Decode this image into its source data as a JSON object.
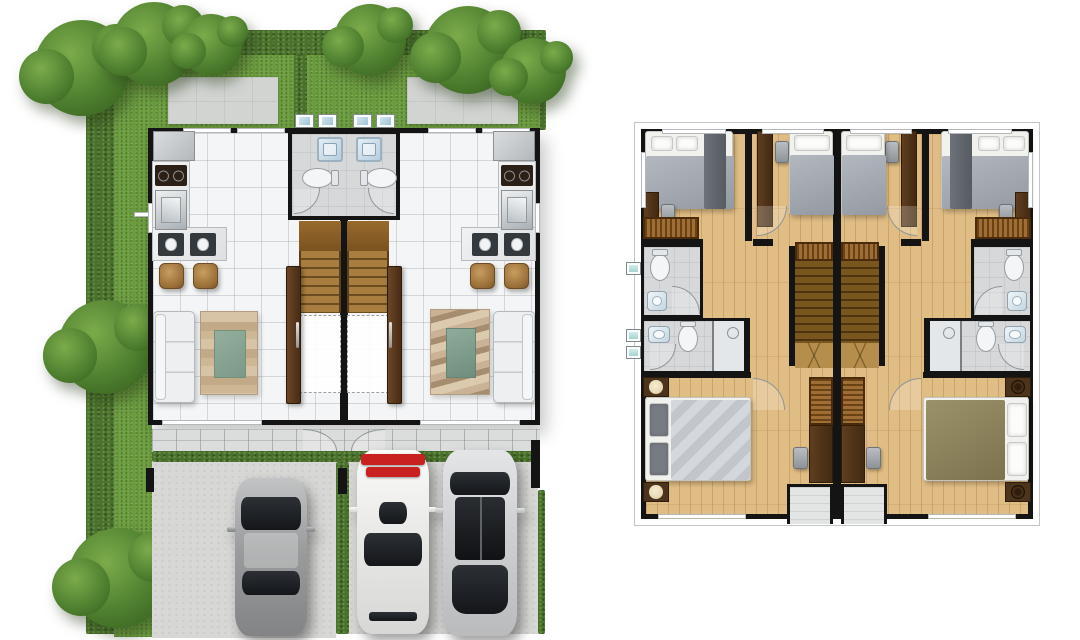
{
  "colors": {
    "wall": "#141414",
    "hedge": "#49722a",
    "grass": "#68993b",
    "tree": "#4e7f2f",
    "treedark": "#3a6520",
    "concrete": "#d2d4d2",
    "tile": "#f4f5f6",
    "bath": "#d6d8da",
    "stove": "#2b1f16",
    "terrace": "#dbdddc",
    "drive": "#d7d8d5",
    "sofa": "#edeff0",
    "rackred": "#c92020",
    "woodfloor": "#e0bd85",
    "bedwhite": "#f1f1ee",
    "lamp": "#e9dab6"
  },
  "plans": [
    {
      "id": "ground-floor-site-plan",
      "position": "left",
      "landscape": {
        "borders": [
          "hedge-top",
          "hedge-left",
          "hedge-right-upper",
          "terrace-hedge-strip",
          "driveway-divider-hedge",
          "right-edge-hedge",
          "front-yard-divider-hedge"
        ],
        "trees": [
          "corner-tree-nw-large",
          "corner-tree-nw-small",
          "tree-n-left",
          "tree-n-center",
          "corner-tree-ne-large",
          "corner-tree-ne-small",
          "tree-west",
          "bush-southwest"
        ],
        "lawn": [
          "front-yard-lawn",
          "west-lawn-strip"
        ],
        "paving": [
          "concrete-pad-left-yard",
          "concrete-pad-right-yard"
        ]
      },
      "units": [
        {
          "name": "unit-a",
          "rooms": [
            {
              "name": "kitchen",
              "furniture": [
                "refrigerator",
                "cooktop",
                "kitchen-sink",
                "l-shaped-counter",
                "breakfast-bar",
                "place-setting",
                "place-setting",
                "bar-stool",
                "bar-stool"
              ]
            },
            {
              "name": "bathroom",
              "furniture": [
                "shower-tray",
                "toilet",
                "door-swing"
              ]
            },
            {
              "name": "living-dining",
              "furniture": [
                "three-seat-sofa",
                "striped-area-rug"
              ]
            },
            {
              "name": "staircase",
              "furniture": [
                "stair-landing",
                "stair-run",
                "under-stair-void"
              ]
            },
            {
              "name": "entry",
              "furniture": [
                "front-door-panel"
              ]
            },
            {
              "name": "terrace",
              "furniture": [
                "door-swing"
              ]
            },
            {
              "name": "driveway",
              "vehicles": [
                "gray-sedan"
              ]
            }
          ],
          "outdoor_equipment": [
            "washing-machine",
            "washing-machine"
          ]
        },
        {
          "name": "unit-b",
          "rooms": [
            {
              "name": "kitchen",
              "furniture": [
                "refrigerator",
                "cooktop",
                "kitchen-sink",
                "l-shaped-counter",
                "breakfast-bar",
                "place-setting",
                "place-setting",
                "bar-stool",
                "bar-stool"
              ]
            },
            {
              "name": "bathroom",
              "furniture": [
                "shower-tray",
                "toilet",
                "door-swing"
              ]
            },
            {
              "name": "living-dining",
              "furniture": [
                "three-seat-sofa",
                "wave-pattern-rug"
              ]
            },
            {
              "name": "staircase",
              "furniture": [
                "stair-landing",
                "stair-run",
                "under-stair-void"
              ]
            },
            {
              "name": "entry",
              "furniture": [
                "front-door-panel"
              ]
            },
            {
              "name": "terrace",
              "furniture": [
                "door-swing"
              ]
            },
            {
              "name": "driveway",
              "vehicles": [
                "white-suv-with-red-roof-rack",
                "silver-car-with-black-glass-roof"
              ]
            }
          ],
          "outdoor_equipment": [
            "washing-machine",
            "washing-machine"
          ]
        }
      ]
    },
    {
      "id": "upper-floor-plan",
      "position": "right",
      "units": [
        {
          "name": "unit-a",
          "rooms": [
            {
              "name": "front-corner-bedroom",
              "furniture": [
                "double-bed",
                "pillow",
                "pillow",
                "desk",
                "chair",
                "wardrobe"
              ]
            },
            {
              "name": "front-middle-bedroom",
              "furniture": [
                "single-bed",
                "pillow",
                "desk",
                "chair",
                "wardrobe"
              ]
            },
            {
              "name": "upper-bathroom",
              "furniture": [
                "toilet",
                "washbasin",
                "door-swing"
              ]
            },
            {
              "name": "lower-bathroom",
              "furniture": [
                "washbasin",
                "toilet",
                "shower-stall",
                "door-swing"
              ]
            },
            {
              "name": "staircase",
              "furniture": [
                "stair-run",
                "stair-foot-landing",
                "wardrobe"
              ]
            },
            {
              "name": "master-bedroom",
              "furniture": [
                "double-bed",
                "pillow",
                "pillow",
                "nightstand-with-lamp",
                "nightstand-with-lamp",
                "wardrobe",
                "desk",
                "chair"
              ]
            },
            {
              "name": "balcony",
              "furniture": []
            }
          ],
          "outdoor_equipment": [
            "ac-condenser",
            "ac-condenser",
            "ac-condenser"
          ]
        },
        {
          "name": "unit-b",
          "rooms": [
            {
              "name": "front-corner-bedroom",
              "furniture": [
                "double-bed",
                "pillow",
                "pillow",
                "desk",
                "chair",
                "wardrobe"
              ]
            },
            {
              "name": "front-middle-bedroom",
              "furniture": [
                "single-bed",
                "pillow",
                "desk",
                "chair",
                "wardrobe"
              ]
            },
            {
              "name": "upper-bathroom",
              "furniture": [
                "toilet",
                "washbasin",
                "door-swing"
              ]
            },
            {
              "name": "lower-bathroom",
              "furniture": [
                "washbasin",
                "toilet",
                "shower-stall",
                "door-swing"
              ]
            },
            {
              "name": "staircase",
              "furniture": [
                "stair-run",
                "stair-foot-landing",
                "wardrobe"
              ]
            },
            {
              "name": "master-bedroom",
              "furniture": [
                "double-bed",
                "pillow",
                "pillow",
                "nightstand-with-speaker",
                "nightstand-with-speaker",
                "wardrobe",
                "desk",
                "chair"
              ]
            },
            {
              "name": "balcony",
              "furniture": []
            }
          ]
        }
      ]
    }
  ]
}
